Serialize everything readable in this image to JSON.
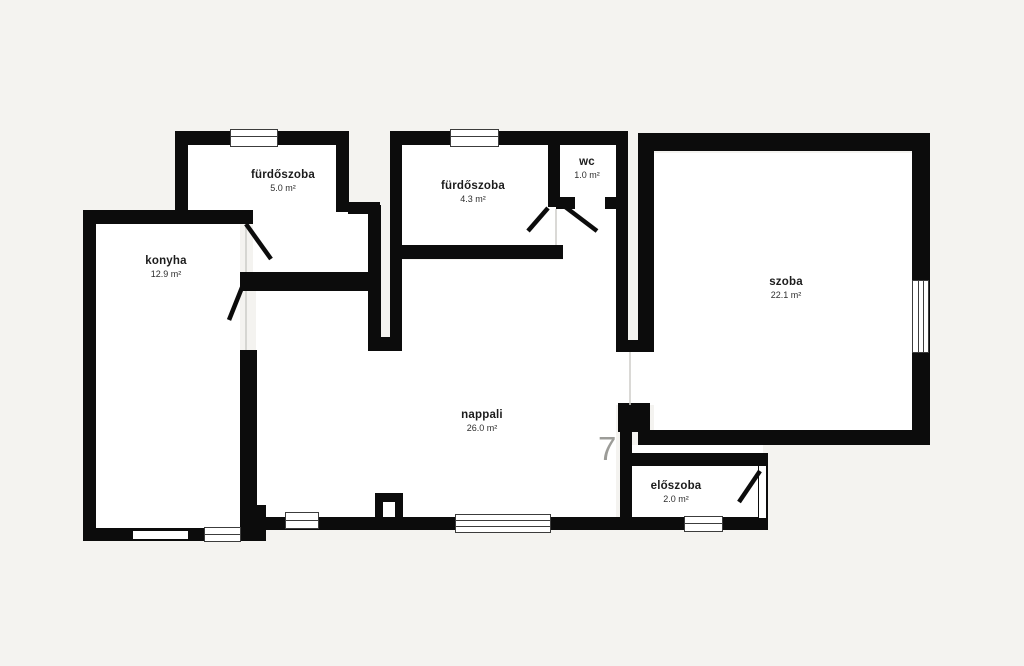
{
  "title": "apartment floor plan",
  "language": "hu",
  "unit_suffix": "m²",
  "colors": {
    "background": "#f4f3f0",
    "wall": "#0c0c0c",
    "room_fill": "#ffffff",
    "label_text": "#1c1c1c",
    "window_frame": "#3c3c3c",
    "watermark": "#9c9c98"
  },
  "rooms": [
    {
      "name": "fürdőszoba",
      "area": "5.0 m²"
    },
    {
      "name": "fürdőszoba",
      "area": "4.3 m²"
    },
    {
      "name": "wc",
      "area": "1.0 m²"
    },
    {
      "name": "szoba",
      "area": "22.1 m²"
    },
    {
      "name": "konyha",
      "area": "12.9 m²"
    },
    {
      "name": "nappali",
      "area": "26.0 m²"
    },
    {
      "name": "előszoba",
      "area": "2.0 m²"
    }
  ],
  "watermark": {
    "text": "7"
  }
}
